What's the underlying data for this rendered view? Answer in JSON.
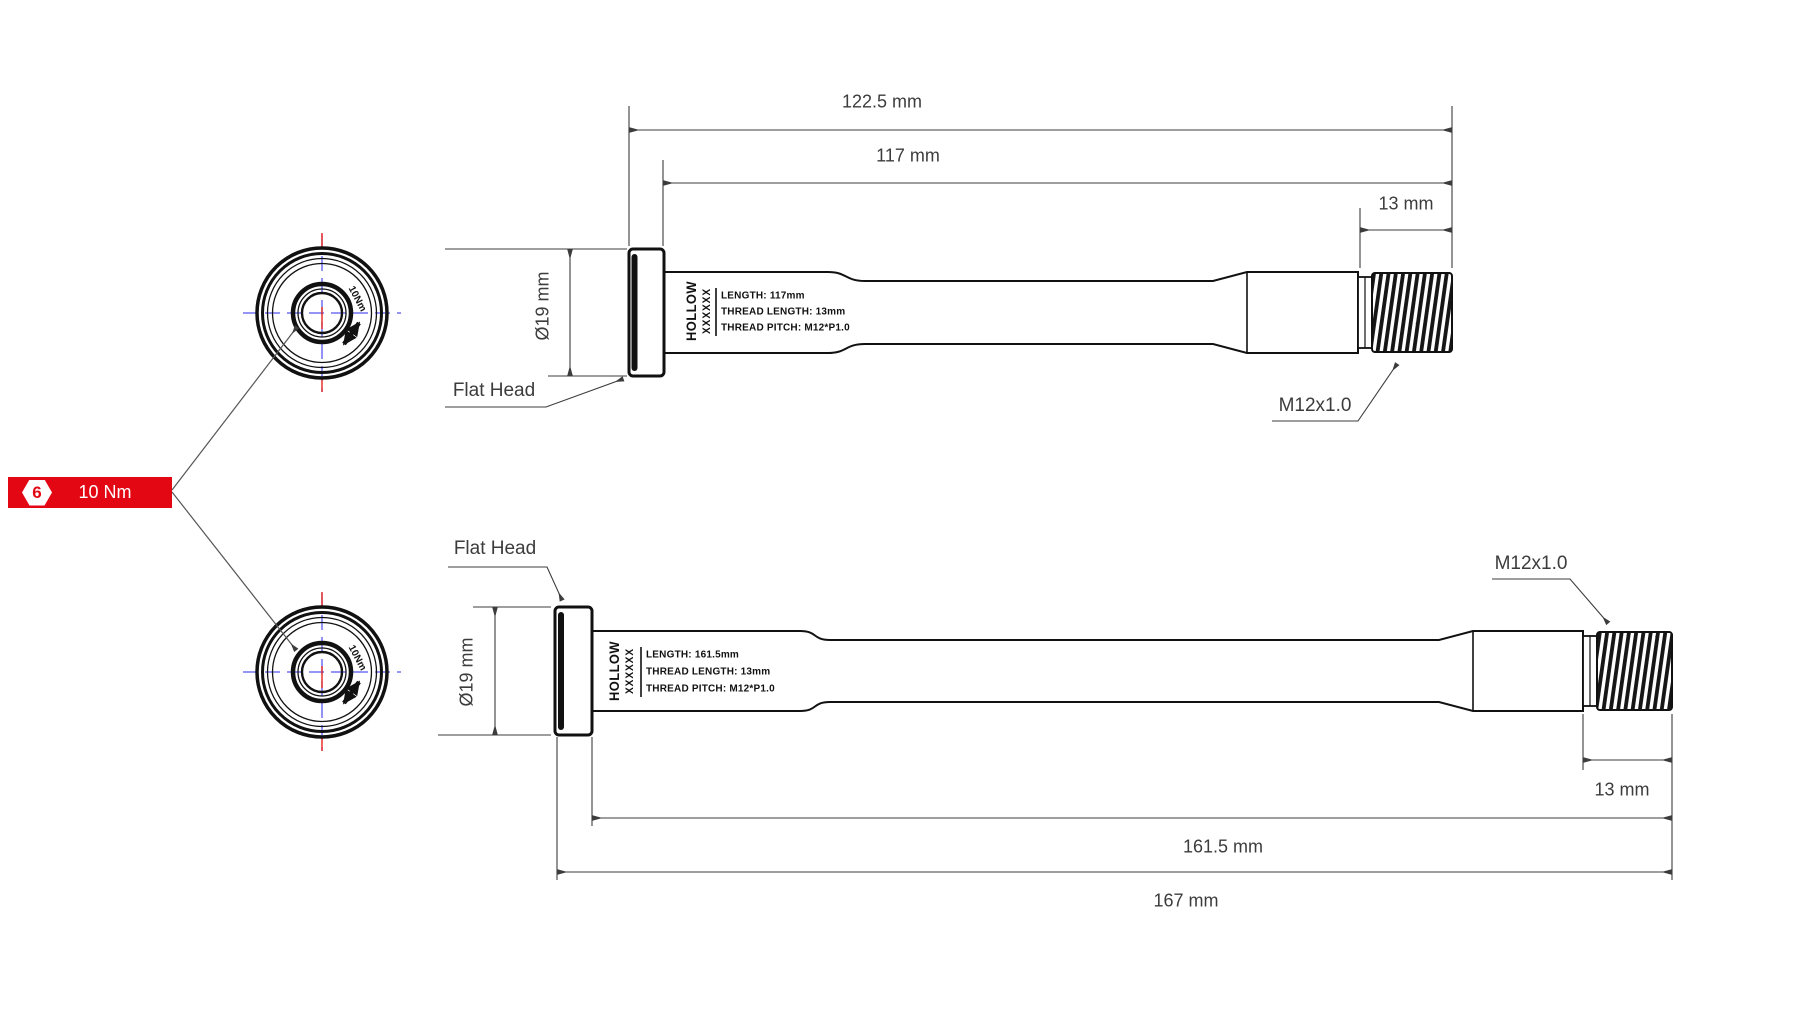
{
  "page": {
    "background": "#ffffff"
  },
  "colors": {
    "line": "#111111",
    "dimension": "#3c3c3c",
    "centerline_blue": "#5656f0",
    "centermark_red": "#e8241d",
    "badge_red": "#e30613"
  },
  "torque_badge": {
    "hex_symbol": "6",
    "label": "10 Nm"
  },
  "axles": [
    {
      "id": "axle-117",
      "brand": "HOLLOW",
      "brand_code": "XXXXXX",
      "specs": [
        "LENGTH: 117mm",
        "THREAD LENGTH: 13mm",
        "THREAD PITCH: M12*P1.0"
      ],
      "dims": {
        "overall": "122.5 mm",
        "length": "117 mm",
        "thread_length": "13 mm",
        "head_diameter": "Ø19 mm"
      },
      "labels": {
        "head": "Flat Head",
        "thread": "M12x1.0"
      },
      "end_view_torque": "10Nm"
    },
    {
      "id": "axle-161_5",
      "brand": "HOLLOW",
      "brand_code": "XXXXXX",
      "specs": [
        "LENGTH: 161.5mm",
        "THREAD LENGTH: 13mm",
        "THREAD PITCH: M12*P1.0"
      ],
      "dims": {
        "overall": "167 mm",
        "length": "161.5 mm",
        "thread_length": "13 mm",
        "head_diameter": "Ø19 mm"
      },
      "labels": {
        "head": "Flat Head",
        "thread": "M12x1.0"
      },
      "end_view_torque": "10Nm"
    }
  ]
}
